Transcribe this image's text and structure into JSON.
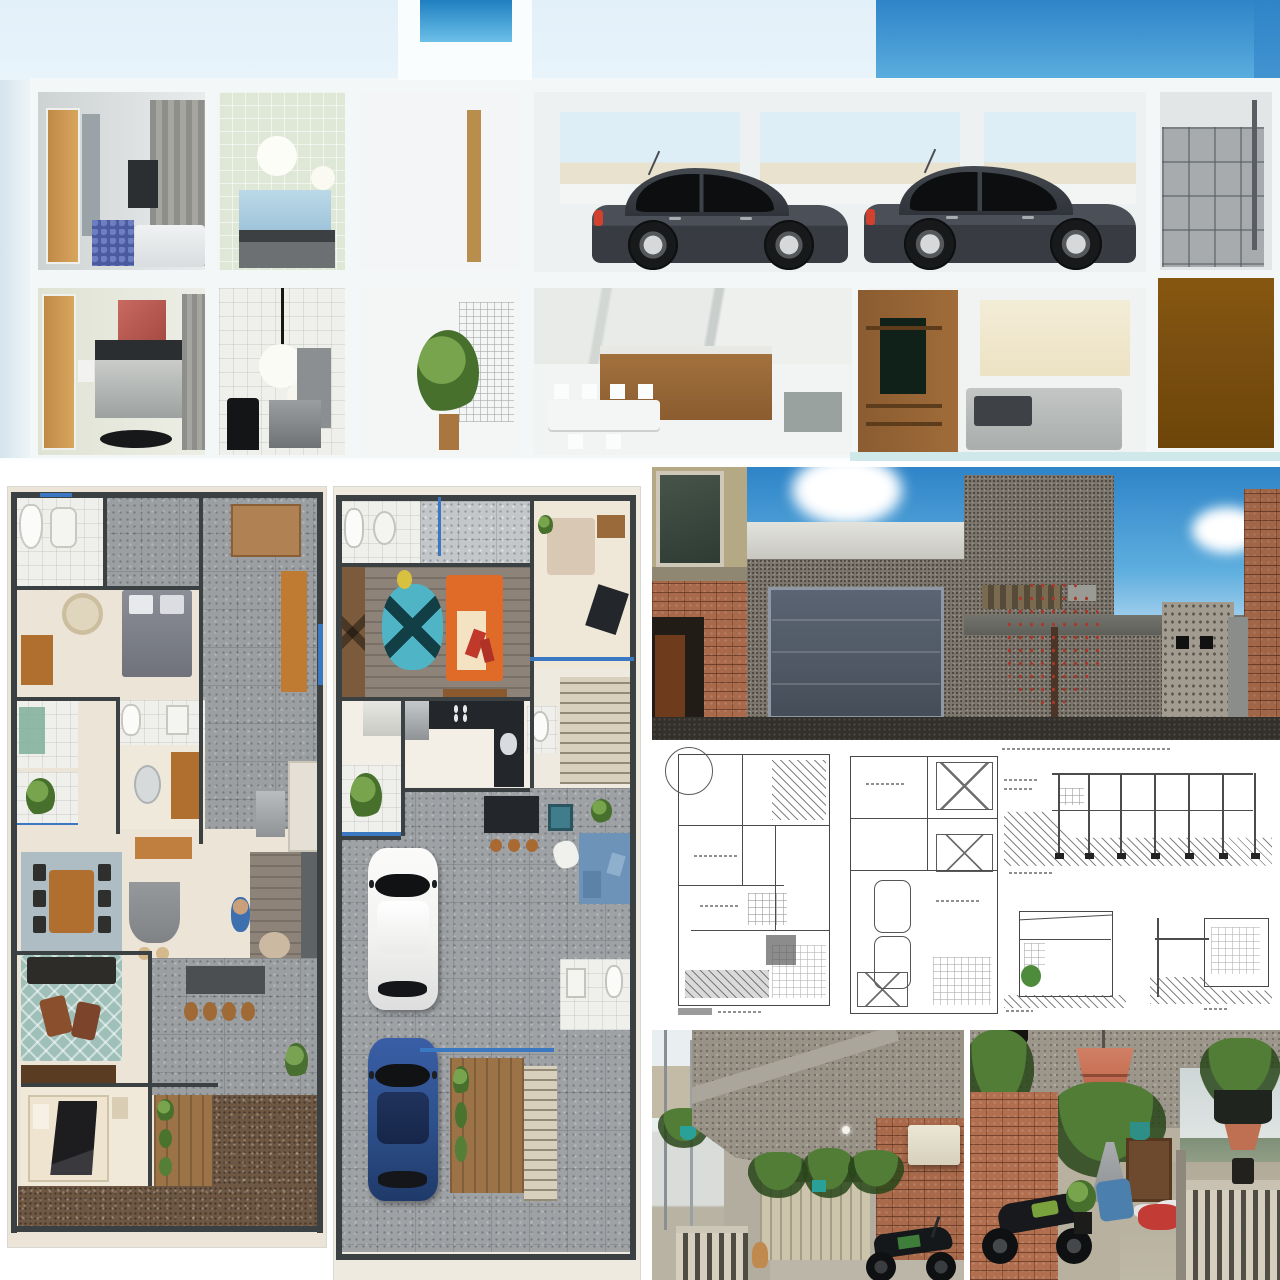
{
  "image": {
    "kind": "architecture-project-collage",
    "label": "Collage: 3D cutaway section render of a two-storey house, two rendered furniture floor plans, a street facade render, a sheet of technical CAD drawings, and two photos of the existing carport and terrace",
    "width": 1280,
    "height": 1280,
    "visible_text": []
  },
  "colors": {
    "skyHaze": "#e6f2fa",
    "sky": "#3f90d3",
    "skyDeep": "#2e84c8",
    "frameWhite": "#f4f7f7",
    "carBody": "#383c42",
    "carWindow": "#0c0e10",
    "brownDoor": "#7b4f10",
    "planWall": "#3b4043",
    "planFloor": "#ece5d7",
    "stoneGray": "#9b9fa2",
    "gravelBrown": "#6e5844",
    "rugTeal": "#9fc0b8",
    "tableWood": "#b06f2e",
    "sofaDark": "#2e2c29",
    "sofaOrange": "#e06b28",
    "rugCyan": "#4fb4c5",
    "carWhite": "#f2f3f1",
    "carBlue": "#2d4f8a",
    "sofaBlue": "#6d93b8",
    "facadeWall": "#7c766c",
    "garageDoor": "#4f5864",
    "treeGreen": "#3f5c33",
    "groundDark": "#33302b",
    "brick": "#a96a4b",
    "concrete": "#989287",
    "gateBeige": "#ccc4ab",
    "fern": "#527d36",
    "potTerracotta": "#c97257",
    "windowBlue": "#3a78c2",
    "cadInk": "#4c4c4c",
    "marble": "#e9ebe9",
    "greenTile": "#dfe7d6"
  },
  "panels": {
    "sectionRender": {
      "label": "3D cutaway (dollhouse) section render of the two-storey house",
      "upper_floor": [
        "bedroom with wood door, grey curtains and white bed",
        "bathroom with green tiles, round mirror lights and blue window",
        "stair hall with sky window",
        "garage with two dark grey hatchback cars",
        "grey entry gate bay"
      ],
      "lower_floor": [
        "bedroom with red artwork and dark bed",
        "bathroom with two white globe pendant lights",
        "winter garden with tall plant and trellis",
        "kitchen with marble wall, wood cabinets and white dining set",
        "TV room with wood media panel and grey sofa",
        "solid brown entry door"
      ]
    },
    "groundFloorPlan": {
      "label": "Rendered ground-floor plan with furniture",
      "rooms": [
        "bathroom",
        "bedroom with grey bed and round rug",
        "green shower bathroom",
        "planted patio",
        "home office",
        "kitchen",
        "dining table for six on blue-grey rug",
        "island with stools",
        "living room with teal diamond rug and dark sofa",
        "barbecue patio with bar stools",
        "bedroom with black-blanket bed",
        "wood deck with bushes",
        "gravel yard"
      ]
    },
    "upperFloorPlan": {
      "label": "Rendered upper-floor plan with furniture and driveway",
      "rooms": [
        "bathroom",
        "grey tiled hall",
        "closet room",
        "living room with orange sofa and cyan rug",
        "kitchen with black island and stove",
        "small bathroom",
        "staircase",
        "side garden with plant",
        "stone driveway with white car and blue car",
        "outdoor lounge with fire pit and blue sofa",
        "rear bathroom",
        "wood deck and steps"
      ]
    },
    "facadeRender": {
      "label": "3D street facade render: stone-clad house with grey sectional garage door, flowering tree, cobble gate block, unfinished neighbour buildings and blue sky"
    },
    "cadSheet": {
      "label": "Technical drawing sheet: two dimensioned floor plans, one long building section and two smaller sections with ground hatching"
    },
    "carportPhoto": {
      "label": "Photo of existing carport: raw concrete slab, brick walls, beige slatted gate, hanging ferns, white wall unit, balustrade and motorcycle"
    },
    "terracePhoto": {
      "label": "Photo of existing covered terrace: hanging terracotta pot and ferns, brick wall, parked motorcycle, stored items and balustrade overlooking hills"
    }
  }
}
